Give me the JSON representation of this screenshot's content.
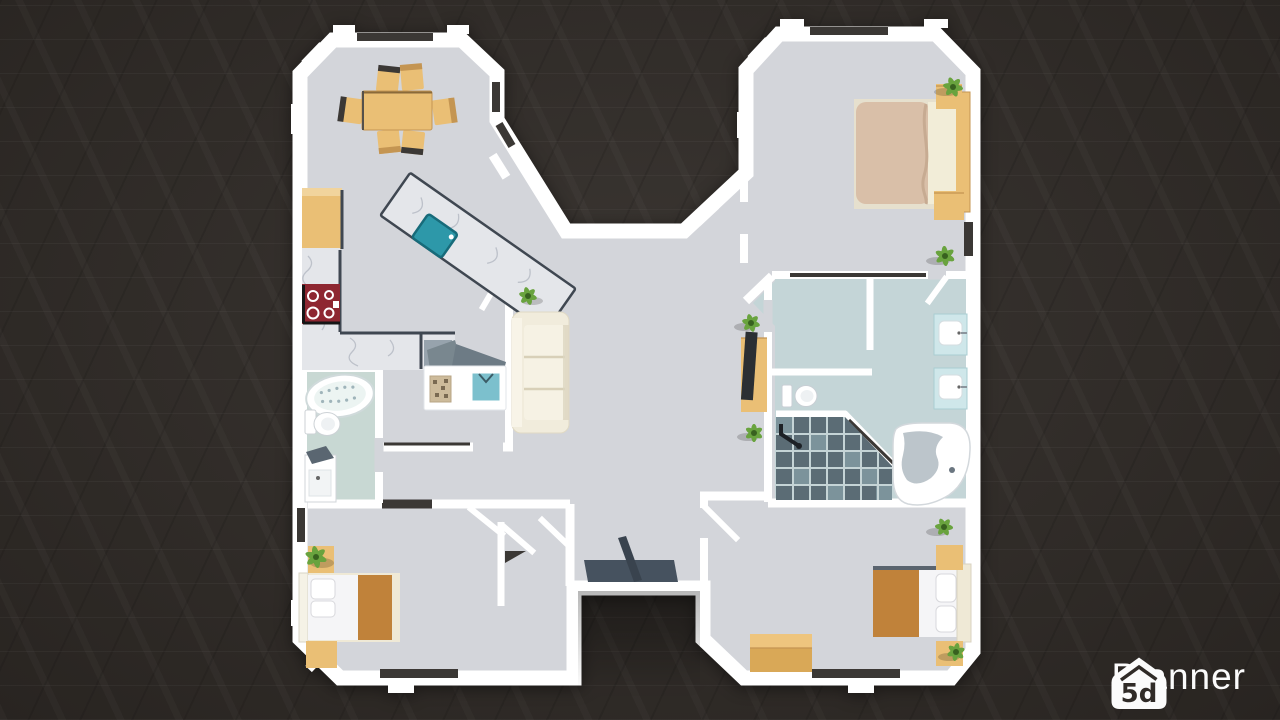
{
  "watermark": {
    "brand": "Planner",
    "icon_text": "5d"
  },
  "colors": {
    "bg": "#302b27",
    "wall": "#ffffff",
    "wall_dark": "#3b3835",
    "floor": "#d3d5da",
    "bath_floor": "#c8d8d3",
    "bath_floor_r": "#c4d5d7",
    "marble": "#e4e6ea",
    "marble_vein": "#a8aeb8",
    "counter_edge": "#3f4751",
    "wood": "#eabf75",
    "wood_dark": "#c49552",
    "wood_face": "#d9a857",
    "blanket_orange": "#c0823a",
    "blanket_beige": "#d9bfa8",
    "sheet": "#f2edd8",
    "linen_white": "#f5f5f7",
    "bedframe": "#efe9d6",
    "sofa": "#f1ecdc",
    "sofa_shade": "#ddd6c0",
    "stove": "#8e2731",
    "teal": "#2d98a9",
    "plant": "#69a33e",
    "plant_dark": "#38611f",
    "tile": "#5b6c75",
    "tile_light": "#8fa9b0",
    "tile_line": "#c5d4d6",
    "tub_water": "#bcc5cb",
    "slate": "#46525f",
    "slate_dark": "#39434e",
    "vanity": "#cfe7ea",
    "gray_top": "#79878f",
    "tv": "#2b2f33",
    "fixture_line": "#c9ced4",
    "logo": "#fbfbfb"
  }
}
